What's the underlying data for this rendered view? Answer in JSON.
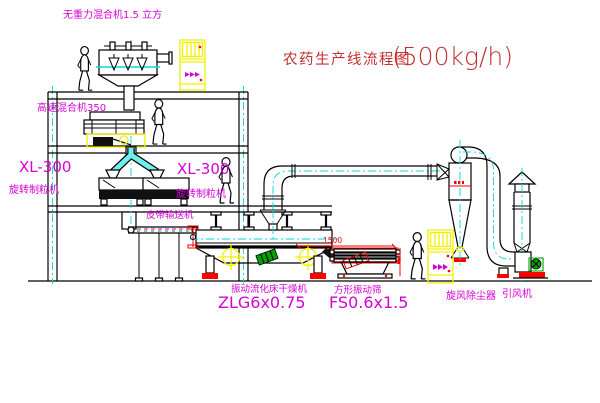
{
  "title": {
    "main": "农药生产线流程图",
    "capacity": "(500kg/h)"
  },
  "labels": {
    "gravity_mixer": "无重力混合机1.5 立方",
    "high_speed_mixer": "高速混合机350",
    "granulator_left_model": "XL-300",
    "granulator_left_name": "旋转制粒机",
    "granulator_center_model": "XL-300",
    "granulator_center_name": "旋转制粒机",
    "belt_conveyor": "皮带输送机",
    "dryer_name": "振动流化床干燥机",
    "dryer_model": "ZLG6x0.75",
    "screen_name": "方形振动筛",
    "screen_model": "FS0.6x1.5",
    "cyclone_name": "旋风除尘器",
    "fan_name": "引风机"
  },
  "dimensions": {
    "dryer_screen_distance": "1500"
  },
  "colors": {
    "line": "#000000",
    "centerline": "#00d8d8",
    "label": "#d400d4",
    "title": "#c03030",
    "dimension": "#ff0000",
    "cabinet": "#f0f000",
    "motor": "#00a000"
  }
}
